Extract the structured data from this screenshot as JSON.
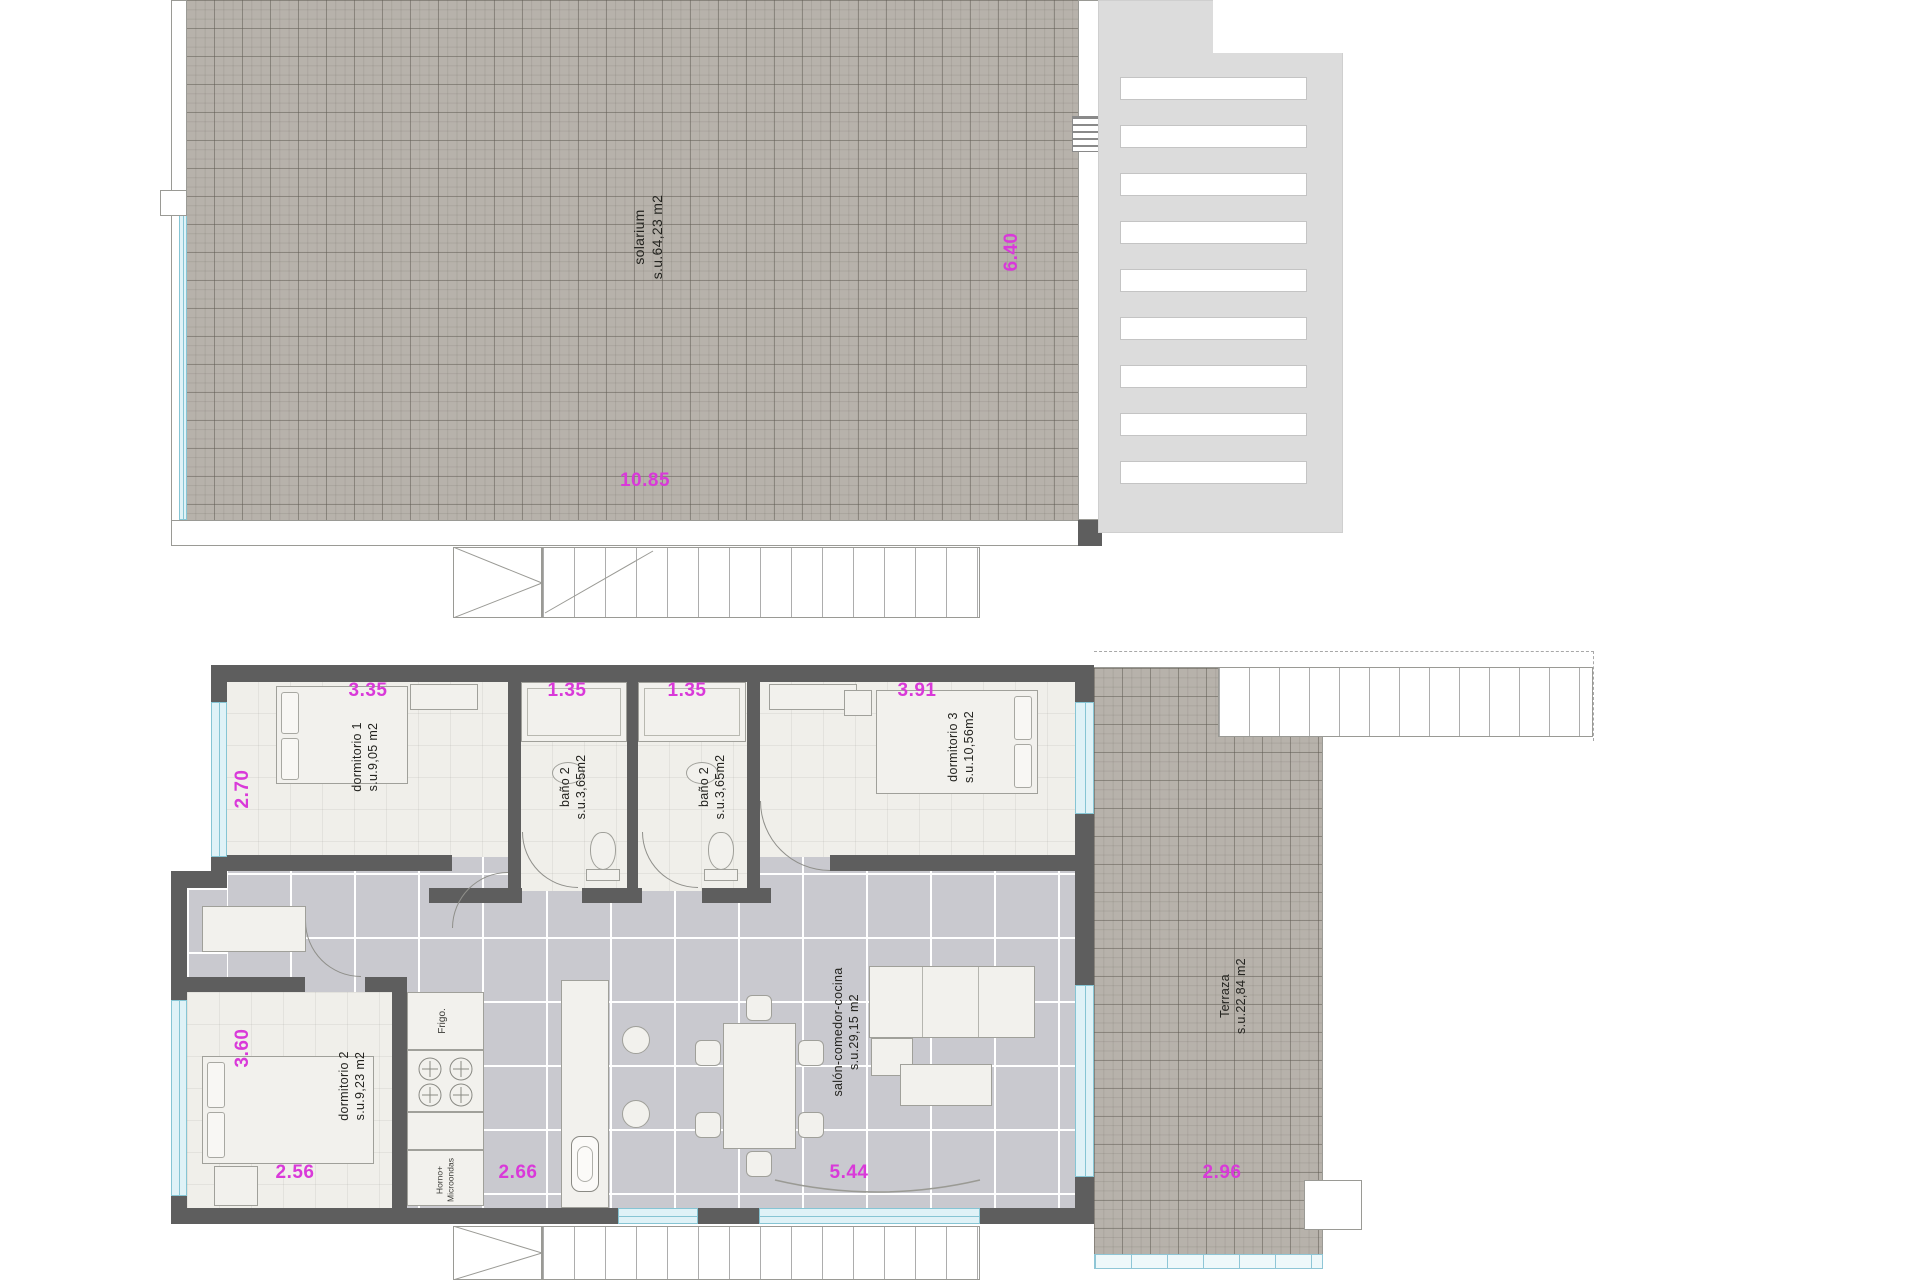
{
  "colors": {
    "dimension_text": "#d939d9",
    "wall": "#5e5e5e",
    "solarium_tile": "#b7b2ab",
    "interior_tile": "#c9c9cf",
    "room_floor": "#f0efea",
    "glass": "#dff2f7"
  },
  "solarium_plan": {
    "room": {
      "name": "solarium",
      "area": "s.u.64,23 m2"
    },
    "dim_width": "10.85",
    "dim_height": "6.40"
  },
  "main_plan": {
    "rooms": {
      "dormitorio1": {
        "name": "dormitorio 1",
        "area": "s.u.9,05 m2"
      },
      "bano_a": {
        "name": "baño 2",
        "area": "s.u.3,65m2"
      },
      "bano_b": {
        "name": "baño 2",
        "area": "s.u.3,65m2"
      },
      "dormitorio3": {
        "name": "dormitorio 3",
        "area": "s.u.10,56m2"
      },
      "dormitorio2": {
        "name": "dormitorio 2",
        "area": "s.u.9,23 m2"
      },
      "salon": {
        "name": "salón-comedor-cocina",
        "area": "s.u.29,15 m2"
      },
      "terraza": {
        "name": "Terraza",
        "area": "s.u.22,84 m2"
      }
    },
    "appliances": {
      "fridge": "Frigo.",
      "oven_line1": "Horno+",
      "oven_line2": "Microondas"
    },
    "dims_top": [
      "3.35",
      "1.35",
      "1.35",
      "3.91"
    ],
    "dims_left": [
      "2.70",
      "3.60"
    ],
    "dims_bottom": [
      "2.56",
      "2.66",
      "5.44",
      "2.96"
    ]
  }
}
